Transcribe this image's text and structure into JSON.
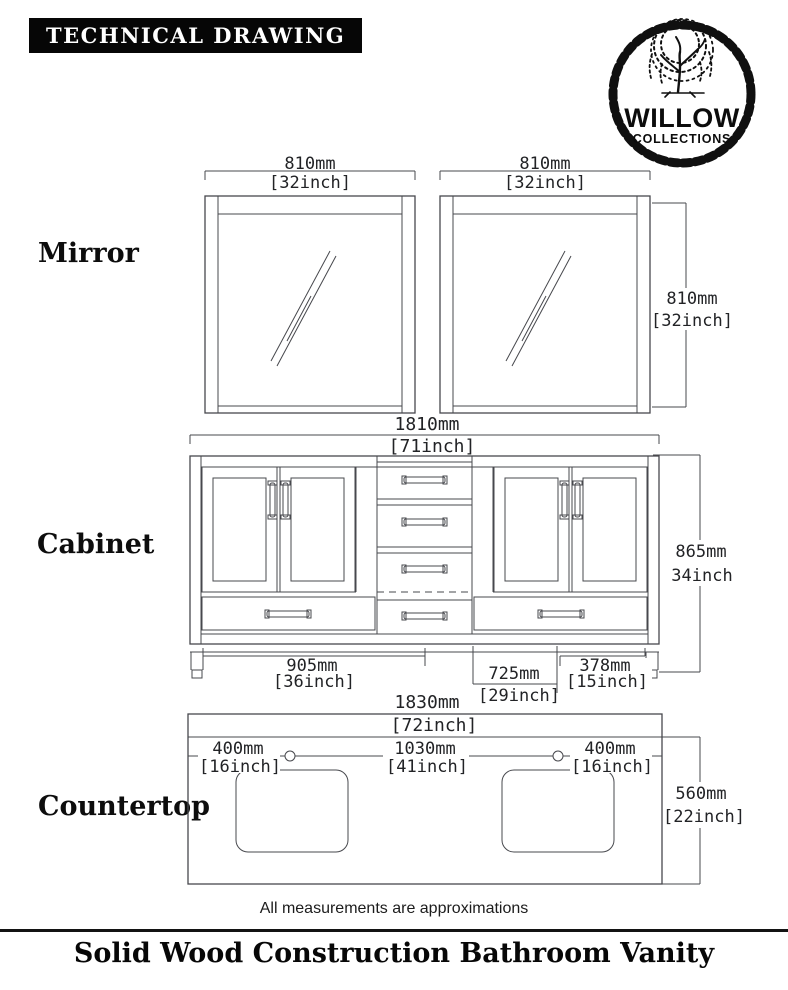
{
  "header": {
    "title": "TECHNICAL DRAWING"
  },
  "logo": {
    "brand": "WILLOW",
    "sub": "COLLECTIONS"
  },
  "sections": {
    "mirror": "Mirror",
    "cabinet": "Cabinet",
    "countertop": "Countertop"
  },
  "dimensions": {
    "mirror_left_width": {
      "mm": "810mm",
      "in": "[32inch]"
    },
    "mirror_right_width": {
      "mm": "810mm",
      "in": "[32inch]"
    },
    "mirror_height": {
      "mm": "810mm",
      "in": "[32inch]"
    },
    "cabinet_width": {
      "mm": "1810mm",
      "in": "[71inch]"
    },
    "cabinet_height": {
      "mm": "865mm",
      "in": "34inch"
    },
    "cabinet_left": {
      "mm": "905mm",
      "in": "[36inch]"
    },
    "cabinet_center": {
      "mm": "725mm",
      "in": "[29inch]"
    },
    "cabinet_right": {
      "mm": "378mm",
      "in": "[15inch]"
    },
    "countertop_width": {
      "mm": "1830mm",
      "in": "[72inch]"
    },
    "countertop_left": {
      "mm": "400mm",
      "in": "[16inch]"
    },
    "countertop_center": {
      "mm": "1030mm",
      "in": "[41inch]"
    },
    "countertop_right": {
      "mm": "400mm",
      "in": "[16inch]"
    },
    "countertop_depth": {
      "mm": "560mm",
      "in": "[22inch]"
    }
  },
  "footer": {
    "note": "All measurements are approximations",
    "title": "Solid Wood Construction Bathroom Vanity"
  },
  "colors": {
    "line": "#47484d",
    "text": "#222326",
    "bar": "#060606"
  }
}
